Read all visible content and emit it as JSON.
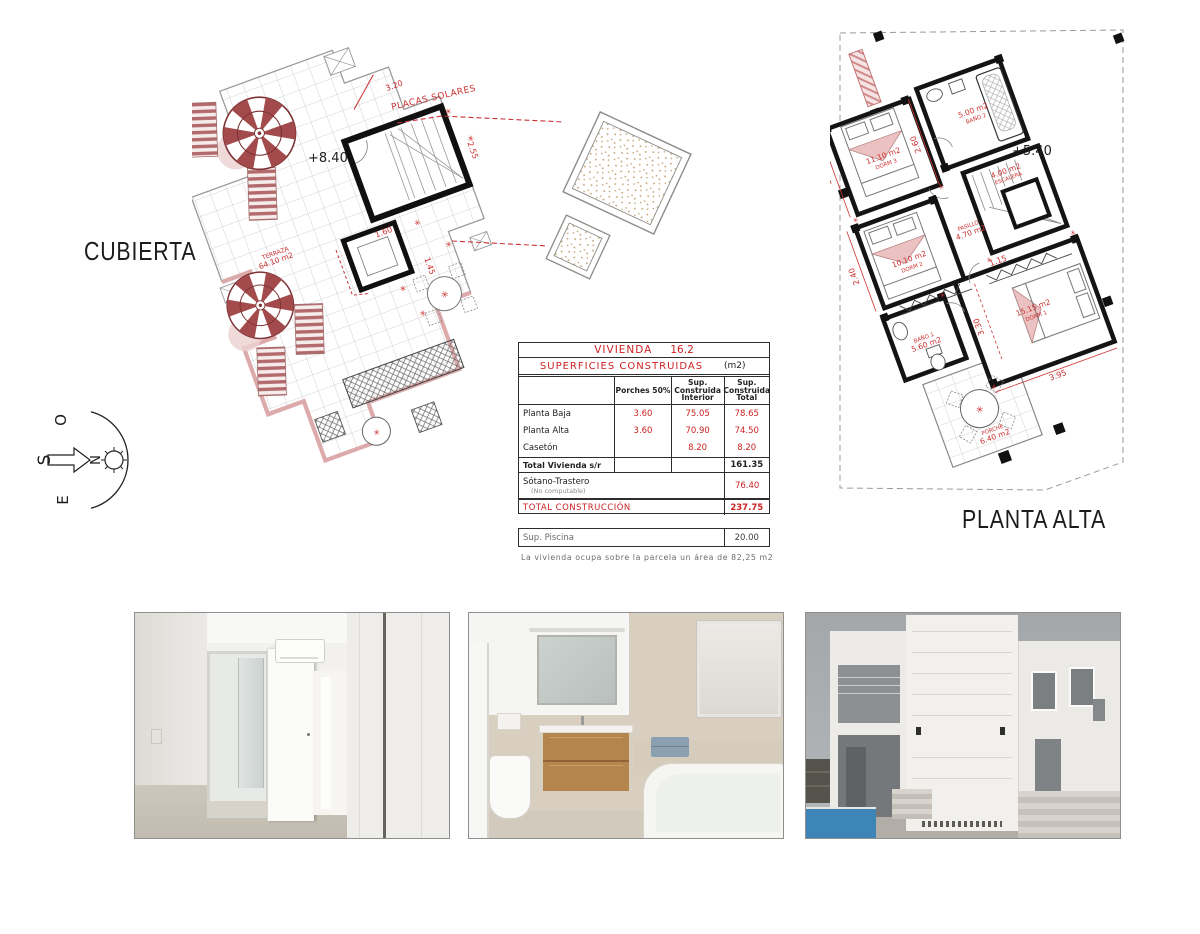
{
  "colors": {
    "accent_red": "#cc2e2e",
    "plan_pink": "#dcaaaa",
    "wall_black": "#141414",
    "pool_blue": "#3c85b6"
  },
  "plans": {
    "cubierta": {
      "label": "CUBIERTA",
      "elevation": "+8.40",
      "terrace_label": "TERRAZA",
      "terrace_area": "64.10 m2",
      "solar_label": "PLACAS SOLARES",
      "dims": {
        "d320": "3.20",
        "d160": "1.60",
        "d255": "2.55",
        "d145": "1.45"
      }
    },
    "planta_alta": {
      "label": "PLANTA ALTA",
      "elevation": "+5.40",
      "rooms": {
        "dorm3": {
          "area": "11.10 m2",
          "name": "DORM 3"
        },
        "bano2": {
          "area": "5.00 m2",
          "name": "BAÑO 2"
        },
        "escalera": {
          "area": "4.00 m2",
          "name": "ESCALERA"
        },
        "pasillo": {
          "area": "4.70 m2",
          "name": "PASILLO"
        },
        "dorm2": {
          "area": "10.10 m2",
          "name": "DORM 2"
        },
        "bano1": {
          "area": "5.60 m2",
          "name": "BAÑO 1"
        },
        "dorm1": {
          "area": "15.15 m2",
          "name": "DORM 1"
        },
        "porche": {
          "area": "6.40 m2",
          "name": "PORCHE"
        }
      },
      "dims": {
        "d195": "1.95",
        "d260": "2.60",
        "d240": "2.40",
        "d115": "1.15",
        "d330": "3.30",
        "d395": "3.95"
      }
    }
  },
  "compass": {
    "o": "O",
    "s": "S",
    "n": "N",
    "e": "E"
  },
  "table": {
    "title_name": "VIVIENDA",
    "title_number": "16.2",
    "subtitle": "SUPERFICIES  CONSTRUIDAS",
    "unit": "(m2)",
    "headers": {
      "porches": "Porches 50%",
      "interior": "Sup.\nConstruida\nInterior",
      "total": "Sup.\nConstruida\nTotal"
    },
    "rows": [
      {
        "label": "Planta Baja",
        "porches": "3.60",
        "interior": "75.05",
        "total": "78.65"
      },
      {
        "label": "Planta Alta",
        "porches": "3.60",
        "interior": "70.90",
        "total": "74.50"
      },
      {
        "label": "Casetón",
        "porches": "",
        "interior": "8.20",
        "total": "8.20"
      }
    ],
    "total_row": {
      "label": "Total Vivienda s/r",
      "value": "161.35"
    },
    "sotano_row": {
      "label": "Sótano-Trastero",
      "note": "(No computable)",
      "value": "76.40"
    },
    "grand_row": {
      "label": "TOTAL CONSTRUCCIÓN",
      "value": "237.75"
    },
    "piscina_row": {
      "label": "Sup. Piscina",
      "value": "20.00"
    },
    "footnote": "La vivienda ocupa sobre la parcela un área de 82,25 m2"
  }
}
